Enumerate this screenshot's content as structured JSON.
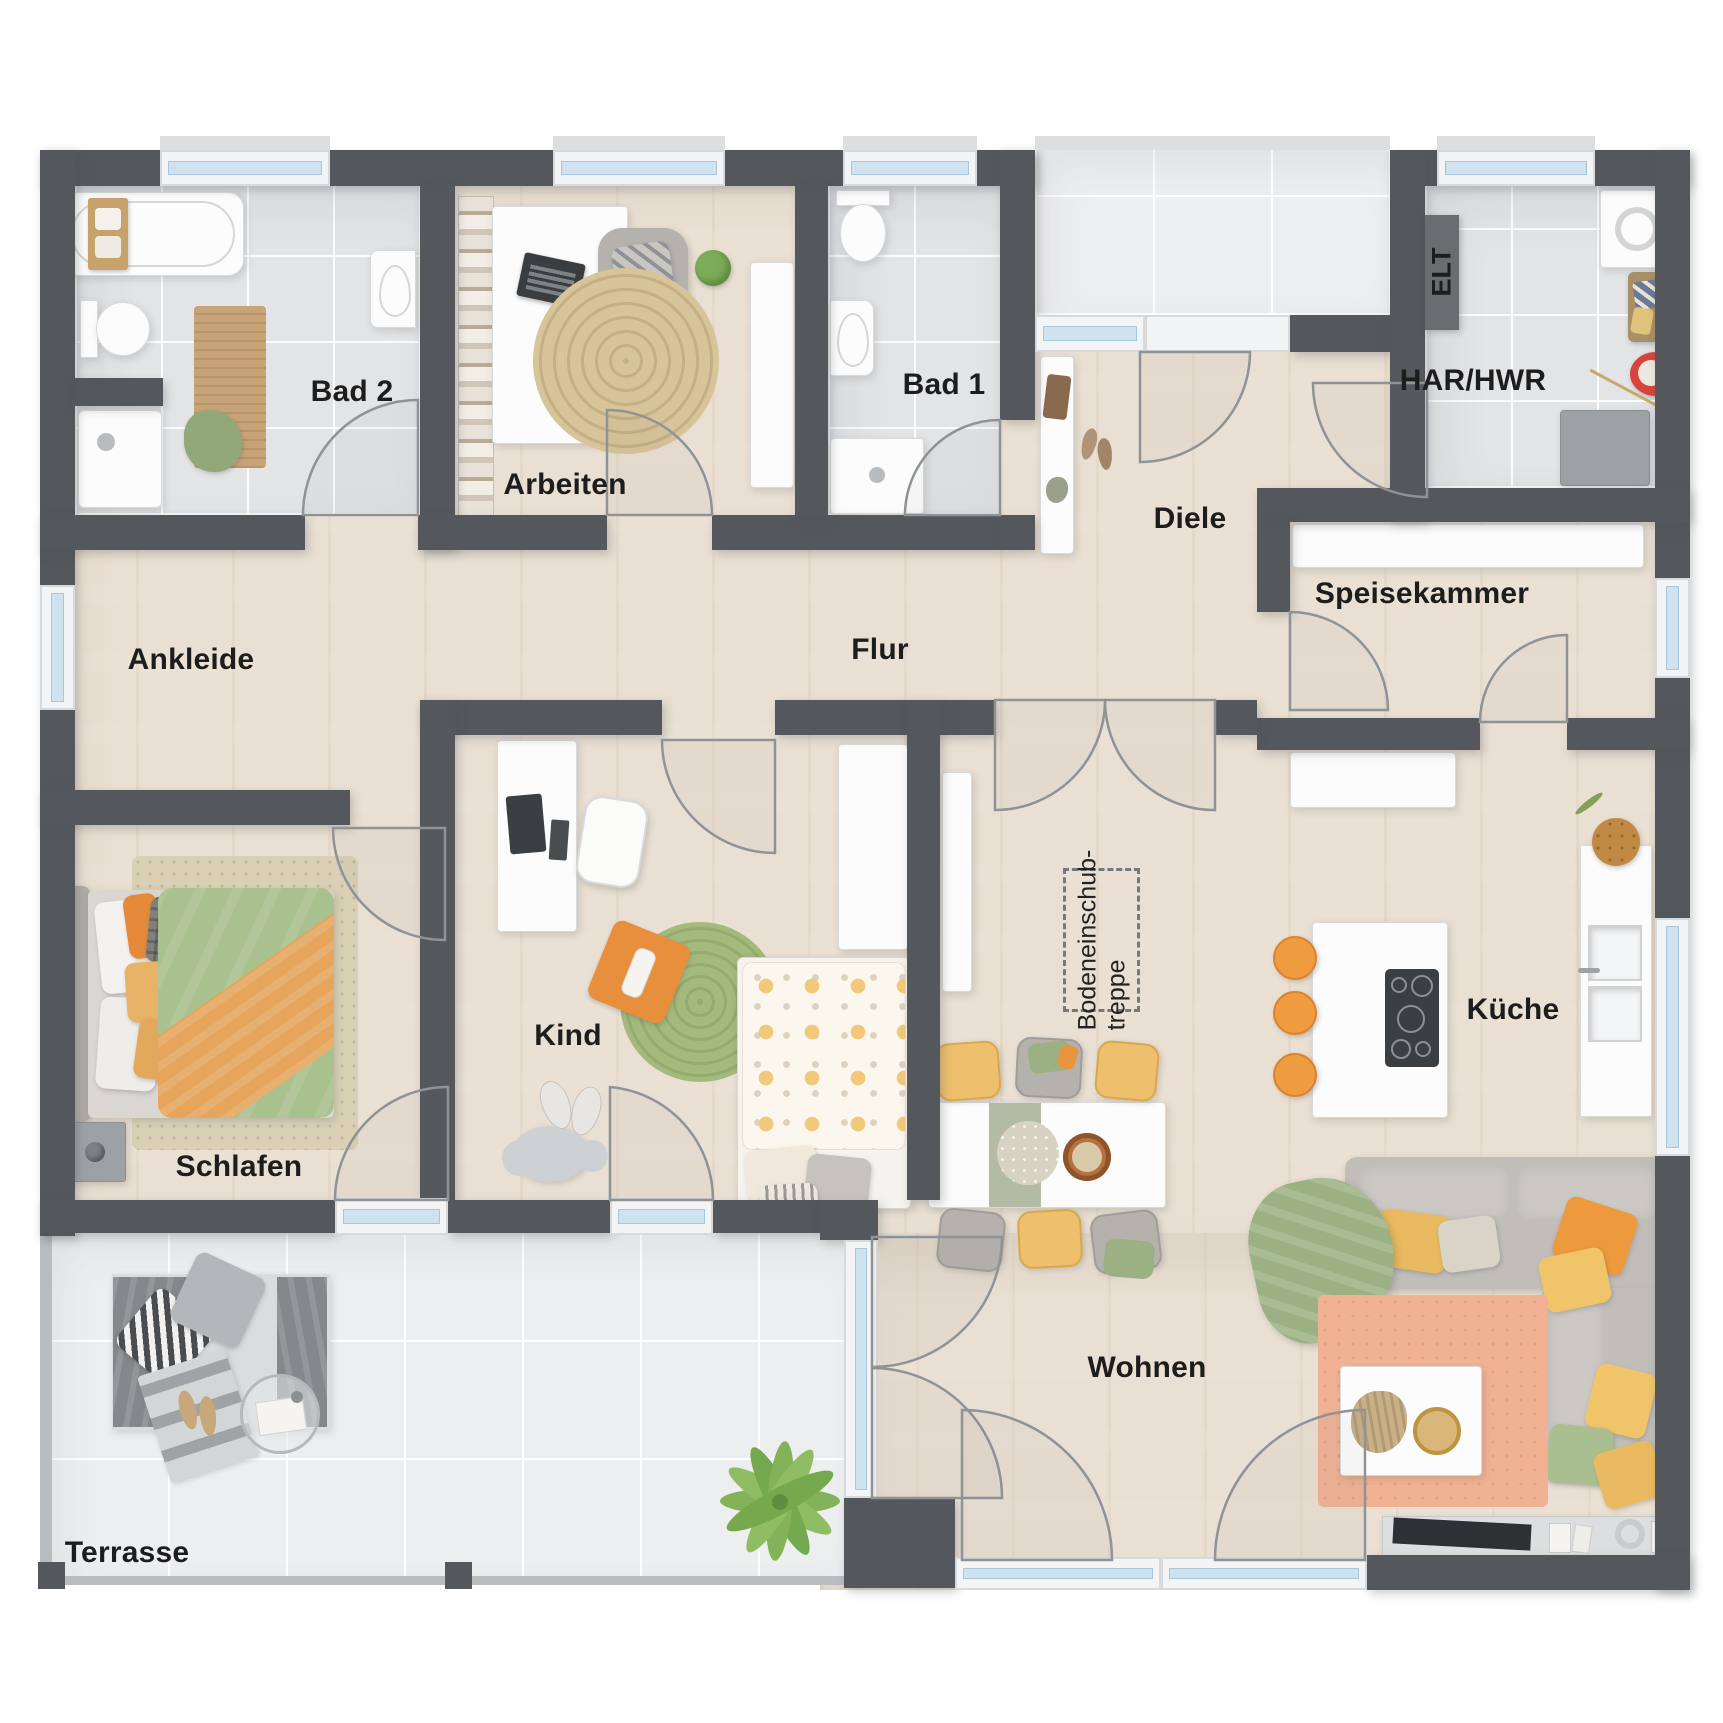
{
  "rooms": {
    "bad2": {
      "label": "Bad 2"
    },
    "arbeiten": {
      "label": "Arbeiten"
    },
    "bad1": {
      "label": "Bad 1"
    },
    "diele": {
      "label": "Diele"
    },
    "har_hwr": {
      "label": "HAR/HWR"
    },
    "elt": {
      "label": "ELT"
    },
    "speisekammer": {
      "label": "Speisekammer"
    },
    "ankleide": {
      "label": "Ankleide"
    },
    "flur": {
      "label": "Flur"
    },
    "kind": {
      "label": "Kind"
    },
    "schlafen": {
      "label": "Schlafen"
    },
    "kueche": {
      "label": "Küche"
    },
    "wohnen": {
      "label": "Wohnen"
    },
    "terrasse": {
      "label": "Terrasse"
    },
    "attic": {
      "line1": "Bodeneinschub-",
      "line2": "treppe"
    }
  },
  "colors": {
    "wall": "#54575b",
    "wood_floor": "#e9dfd2",
    "tile_floor": "#e2e4e6",
    "terrace_tile": "#edeef0",
    "window_glass": "#cfe2f0",
    "accent_orange": "#ef9c40",
    "accent_yellow": "#eec06d",
    "accent_green": "#a4b97c",
    "sofa_gray": "#c1beba",
    "rug_salmon": "#f1b294"
  }
}
